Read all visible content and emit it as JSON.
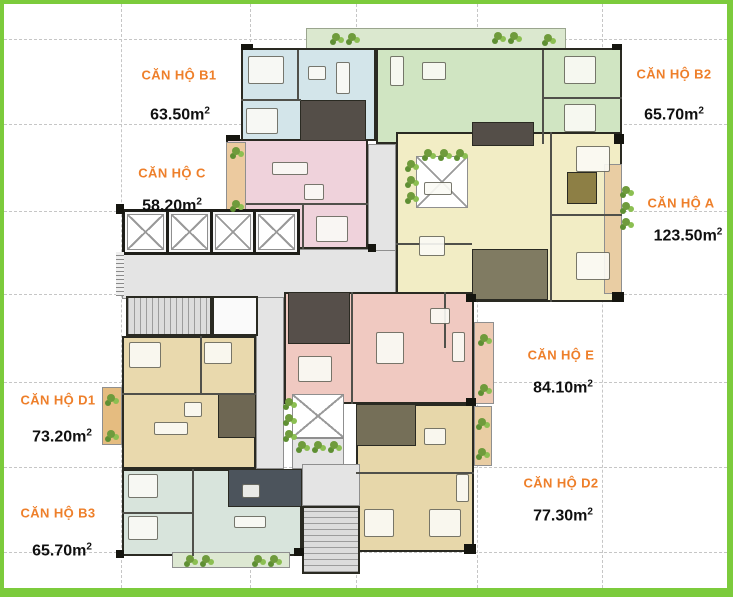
{
  "frame": {
    "border_color": "#7ccb3c",
    "background": "#ffffff"
  },
  "units": [
    {
      "id": "B1",
      "label": "CĂN HỘ B1",
      "area": "63.50m",
      "area_sup": "2",
      "color": "#d3e5ea"
    },
    {
      "id": "B2",
      "label": "CĂN HỘ B2",
      "area": "65.70m",
      "area_sup": "2",
      "color": "#d0e5c2"
    },
    {
      "id": "C",
      "label": "CĂN HỘ C",
      "area": "58.20m",
      "area_sup": "2",
      "color": "#efd2db"
    },
    {
      "id": "A",
      "label": "CĂN HỘ A",
      "area": "123.50m",
      "area_sup": "2",
      "color": "#f2edc5"
    },
    {
      "id": "D1",
      "label": "CĂN HỘ D1",
      "area": "73.20m",
      "area_sup": "2",
      "color": "#e9d9ad"
    },
    {
      "id": "E",
      "label": "CĂN HỘ E",
      "area": "84.10m",
      "area_sup": "2",
      "color": "#f0c9c1"
    },
    {
      "id": "B3",
      "label": "CĂN HỘ B3",
      "area": "65.70m",
      "area_sup": "2",
      "color": "#d8e4dc"
    },
    {
      "id": "D2",
      "label": "CĂN HỘ D2",
      "area": "77.30m",
      "area_sup": "2",
      "color": "#e7d7aa"
    }
  ],
  "colors": {
    "label_orange": "#ee7f2a",
    "wall_dark": "#2a2a22",
    "corridor_gray": "#e4e4e4",
    "balcony_tan": "#e9cda3",
    "terrace_green": "#dbe8cf",
    "plant_green": "#6f9b3c",
    "bath_dark": "#544e48",
    "bath_olive": "#807b62",
    "bath_slate": "#4c545c",
    "grid_gray": "#c6c6c6"
  }
}
